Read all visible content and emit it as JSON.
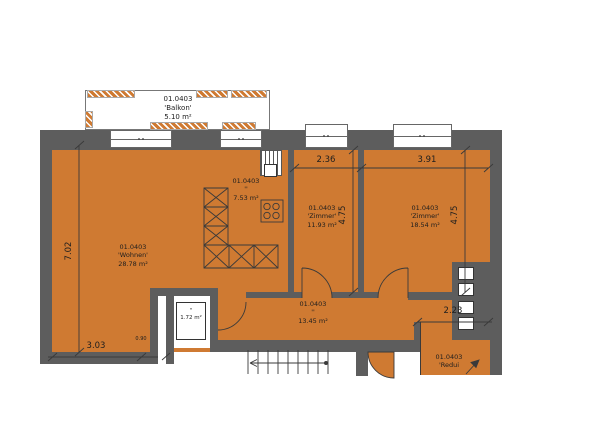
{
  "plan": {
    "project_code": "01.0403",
    "rooms": {
      "balkon": {
        "code": "01.0403",
        "name": "'Balkon'",
        "area": "5.10 m²"
      },
      "wohnen": {
        "code": "01.0403",
        "name": "'Wohnen'",
        "area": "28.78 m²"
      },
      "kueche": {
        "code": "01.0403",
        "name": "''",
        "area": "7.53 m²"
      },
      "zimmer_1": {
        "code": "01.0403",
        "name": "'Zimmer'",
        "area": "11.93 m²"
      },
      "zimmer_2": {
        "code": "01.0403",
        "name": "'Zimmer'",
        "area": "18.54 m²"
      },
      "korridor": {
        "code": "01.0403",
        "name": "''",
        "area": "13.45 m²"
      },
      "nasszelle": {
        "name": "''",
        "area": "1.72 m²"
      },
      "reduit": {
        "code": "01.0403",
        "name": "'Redui"
      }
    },
    "dimensions": {
      "left_height": "7.02",
      "bottom_left_width": "3.03",
      "door_width": "0.90",
      "zimmer_1_width": "2.36",
      "zimmer_2_width": "3.91",
      "zimmer_1_height": "4.75",
      "zimmer_2_height": "4.75",
      "reduit_width": "2.23"
    }
  },
  "colors": {
    "floor": "#cf7a32",
    "wall": "#5d5d5d",
    "line": "#3a3a3a"
  }
}
